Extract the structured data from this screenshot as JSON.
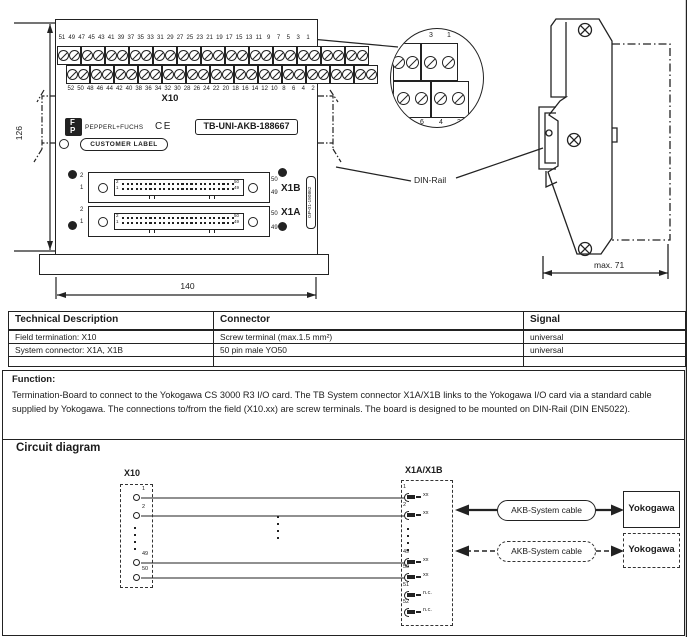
{
  "front_view": {
    "dim_height": "126",
    "dim_width": "140",
    "terminal_block_label": "X10",
    "top_terminal_numbers": [
      "51",
      "49",
      "47",
      "45",
      "43",
      "41",
      "39",
      "37",
      "35",
      "33",
      "31",
      "29",
      "27",
      "25",
      "23",
      "21",
      "19",
      "17",
      "15",
      "13",
      "11",
      "9",
      "7",
      "5",
      "3",
      "1"
    ],
    "bottom_terminal_numbers": [
      "52",
      "50",
      "48",
      "46",
      "44",
      "42",
      "40",
      "38",
      "36",
      "34",
      "32",
      "30",
      "28",
      "26",
      "24",
      "22",
      "20",
      "18",
      "16",
      "14",
      "12",
      "10",
      "8",
      "6",
      "4",
      "2"
    ],
    "logo_letter_top": "F",
    "logo_letter_bottom": "P",
    "brand": "PEPPERL+FUCHS",
    "ce_mark": "CE",
    "product_label": "TB-UNI-AKB-188667",
    "customer_label": "CUSTOMER LABEL",
    "board_code_vertical": "GP-01-190862",
    "connectors": [
      {
        "label": "X1B",
        "outer_top_left": "2",
        "outer_bottom_left": "1",
        "outer_top_right": "50",
        "outer_bottom_right": "49",
        "inner_top_left": "2",
        "inner_bottom_left": "1",
        "inner_top_right": "50",
        "inner_bottom_right": "49"
      },
      {
        "label": "X1A",
        "outer_top_left": "2",
        "outer_bottom_left": "1",
        "outer_top_right": "50",
        "outer_bottom_right": "49",
        "inner_top_left": "2",
        "inner_bottom_left": "1",
        "inner_top_right": "50",
        "inner_bottom_right": "49"
      }
    ]
  },
  "detail_view": {
    "top_numbers": [
      "3",
      "1"
    ],
    "bottom_numbers": [
      "6",
      "4",
      "2"
    ]
  },
  "side_view": {
    "dim_depth": "max. 71",
    "din_rail_label": "DIN-Rail"
  },
  "spec_table": {
    "headers": [
      "Technical Description",
      "Connector",
      "Signal"
    ],
    "rows": [
      [
        "Field termination: X10",
        "Screw terminal (max.1.5 mm²)",
        "universal"
      ],
      [
        "System connector: X1A, X1B",
        "50 pin male YO50",
        "universal"
      ],
      [
        "",
        "",
        ""
      ]
    ]
  },
  "function_section": {
    "title": "Function:",
    "body": "Termination-Board to connect to the Yokogawa CS 3000 R3 I/O card. The TB System connector X1A/X1B links to the Yokogawa I/O card via a standard cable supplied by Yokogawa. The connections to/from the field (X10.xx) are screw terminals. The board is designed to be mounted on DIN-Rail (DIN EN5022)."
  },
  "circuit": {
    "title": "Circuit diagram",
    "x10": {
      "label": "X10",
      "pins": [
        "1",
        "2",
        "49",
        "50"
      ]
    },
    "x1ab": {
      "label": "X1A/X1B",
      "pins": [
        {
          "n": "1",
          "t": "xx"
        },
        {
          "n": "2",
          "t": "xx"
        },
        {
          "n": "49",
          "t": "xx"
        },
        {
          "n": "50",
          "t": "xx"
        },
        {
          "n": "51",
          "t": "n.c."
        },
        {
          "n": "52",
          "t": "n.c."
        }
      ]
    },
    "cable_solid": "AKB-System cable",
    "cable_dashed": "AKB-System cable",
    "target_solid": "Yokogawa",
    "target_dashed": "Yokogawa"
  }
}
